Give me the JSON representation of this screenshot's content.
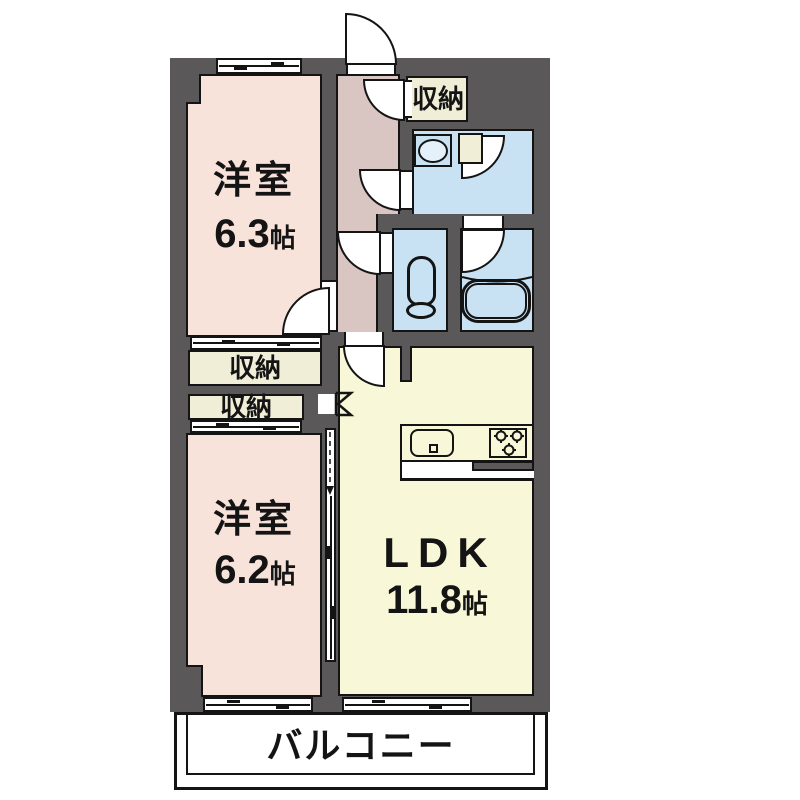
{
  "plan": {
    "rooms": {
      "bedroom1": {
        "label": "洋室",
        "size": "6.3",
        "unit": "帖"
      },
      "bedroom2": {
        "label": "洋室",
        "size": "6.2",
        "unit": "帖"
      },
      "ldk": {
        "label": "LDK",
        "size": "11.8",
        "unit": "帖"
      },
      "entrance_closet": {
        "label": "収納"
      },
      "closet1": {
        "label": "収納"
      },
      "closet2": {
        "label": "収納"
      },
      "balcony": {
        "label": "バルコニー"
      }
    },
    "colors": {
      "wall": "#5b5859",
      "line": "#141414",
      "bedroom": "#f8e3da",
      "hallway": "#d9c5c2",
      "closet": "#f1eed7",
      "ldk": "#f8f7d8",
      "water": "#c8e2f3",
      "balcony": "#ffffff"
    }
  }
}
